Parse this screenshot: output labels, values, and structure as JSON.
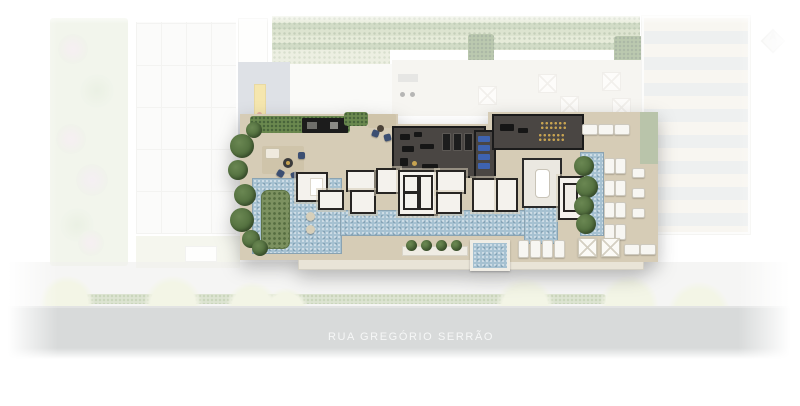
{
  "street": {
    "label": "RUA GREGÓRIO SERRÃO"
  },
  "icons": {
    "compass": "north-arrow-compass"
  },
  "colors": {
    "water": "#a6c1d1",
    "deck": "#d6ccb6",
    "deck-light": "#e9e4d7",
    "wall": "#272523",
    "room": "#f4f2ed",
    "gym": "#4a4643",
    "mat": "#3e63b0",
    "dumbbell": "#c7a351",
    "hedge": "#6b894f",
    "hedge-dark": "#48643a",
    "tree": "#526f3e",
    "island": "#7c9160",
    "rug": "#cfc4aa",
    "navy": "#3c4f72",
    "fireplace": "#e9c94d",
    "terrace": "#b7bec9",
    "lounger": "#f7f6f2",
    "pergola-cream": "#f0ede1",
    "pergola-gray": "#dbdee0",
    "garden": "#e3ead7",
    "lawn": "#e9edda",
    "rows-a": "#c9d5ad",
    "rows-b": "#9cb385",
    "street": "#d8dada",
    "street-text": "#f6f7f7",
    "sidewalk": "#f1f1ef",
    "canopy": "#edf0da"
  }
}
